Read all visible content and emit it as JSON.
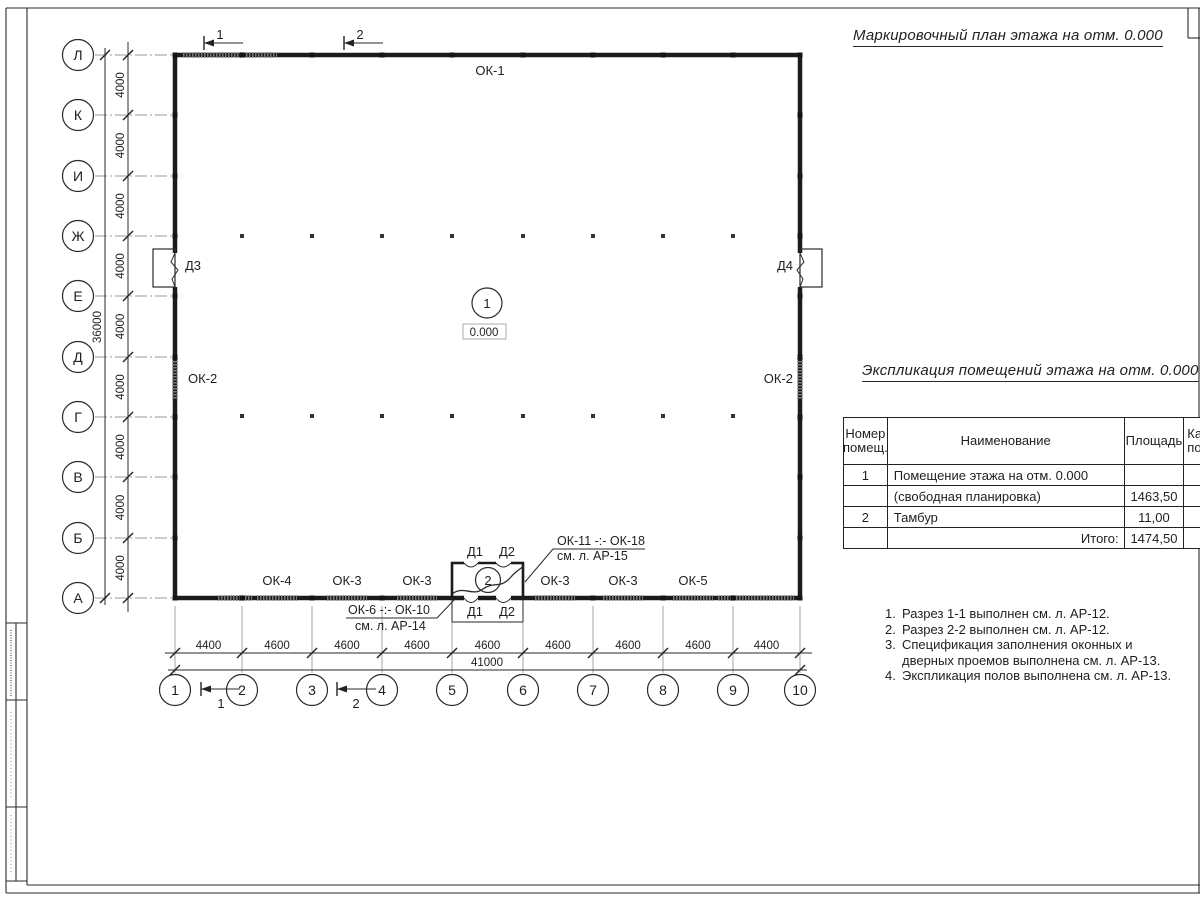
{
  "sheet": {
    "plan_title": "Маркировочный план этажа на отм. 0.000",
    "table_title": "Экспликация помещений этажа на отм. 0.000"
  },
  "axes": {
    "rows": [
      "Л",
      "К",
      "И",
      "Ж",
      "Е",
      "Д",
      "Г",
      "В",
      "Б",
      "А"
    ],
    "row_dim": "4000",
    "row_total": "36000",
    "cols": [
      "1",
      "2",
      "3",
      "4",
      "5",
      "6",
      "7",
      "8",
      "9",
      "10"
    ],
    "col_dims": [
      "4400",
      "4600",
      "4600",
      "4600",
      "4600",
      "4600",
      "4600",
      "4600",
      "4400"
    ],
    "col_total": "41000"
  },
  "plan": {
    "room1_number": "1",
    "room1_level": "0.000",
    "room2_number": "2",
    "window_top": "ОК-1",
    "window_left": "ОК-2",
    "window_right": "ОК-2",
    "windows_bottom": [
      "ОК-4",
      "ОК-3",
      "ОК-3",
      "ОК-3",
      "ОК-3",
      "ОК-5"
    ],
    "door_left": "Д3",
    "door_right": "Д4",
    "tambour_top_doors": [
      "Д1",
      "Д2"
    ],
    "tambour_bottom_doors": [
      "Д1",
      "Д2"
    ],
    "leader_top_line1": "ОК-11 -:- ОК-18",
    "leader_top_line2": "см. л. АР-15",
    "leader_bottom_line1": "ОК-6 -:- ОК-10",
    "leader_bottom_line2": "см. л. АР-14",
    "section_marker_1": "1",
    "section_marker_2": "2"
  },
  "table": {
    "headers": {
      "col1_line1": "Номер",
      "col1_line2": "помещ.",
      "col2": "Наименование",
      "col3": "Площадь",
      "col4_line1": "Ка",
      "col4_line2": "по"
    },
    "rows": [
      {
        "num": "1",
        "name": "Помещение этажа на отм. 0.000",
        "area": "",
        "align": "left"
      },
      {
        "num": "",
        "name": "(свободная планировка)",
        "area": "1463,50",
        "align": "left"
      },
      {
        "num": "2",
        "name": "Тамбур",
        "area": "11,00",
        "align": "left"
      },
      {
        "num": "",
        "name": "Итого:",
        "area": "1474,50",
        "align": "right"
      }
    ]
  },
  "notes": [
    {
      "num": "1.",
      "text": "Разрез 1-1 выполнен см. л. АР-12."
    },
    {
      "num": "2.",
      "text": "Разрез 2-2 выполнен см. л. АР-12."
    },
    {
      "num": "3.",
      "text": "Спецификация заполнения оконных и дверных проемов выполнена см. л. АР-13."
    },
    {
      "num": "4.",
      "text": "Экспликация полов выполнена см. л. АР-13."
    }
  ],
  "colors": {
    "line": "#2a2a2a",
    "wall": "#1b1b1b",
    "light": "#9a9a9a"
  }
}
